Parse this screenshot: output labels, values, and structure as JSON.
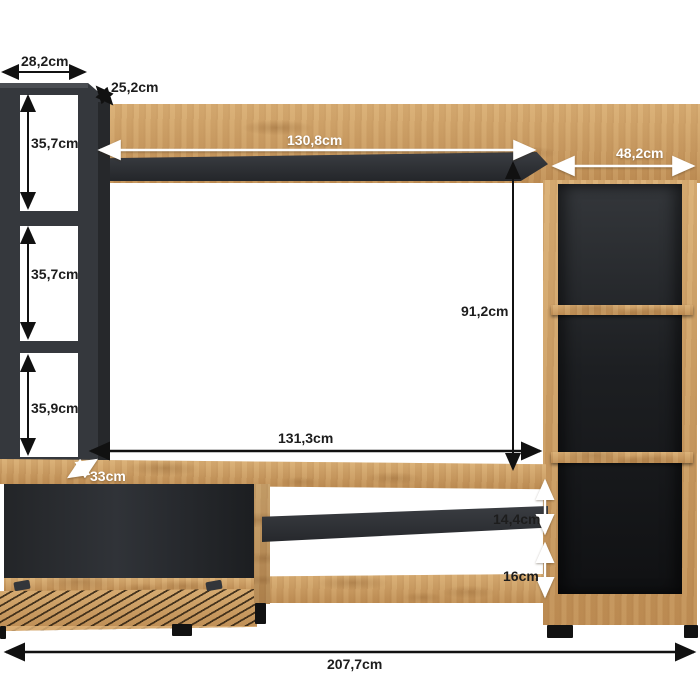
{
  "dims": {
    "left_unit_width": "28,2cm",
    "left_unit_depth": "25,2cm",
    "cubby_top_height": "35,7cm",
    "cubby_middle_height": "35,7cm",
    "cubby_bottom_height": "35,9cm",
    "wall_shelf_width": "130,8cm",
    "right_cabinet_width": "48,2cm",
    "niche_height": "91,2cm",
    "niche_width": "131,3cm",
    "tv_stand_depth": "33cm",
    "open_shelf_gap_upper": "14,4cm",
    "open_shelf_gap_lower": "16cm",
    "total_width": "207,7cm"
  },
  "colors": {
    "background": "#ffffff",
    "oak": "#c9995e",
    "anthracite_front": "#35383d",
    "anthracite_side": "#26282b",
    "glossy_back": "#1a1c1e",
    "arrow_black": "#111111",
    "arrow_white": "#ffffff",
    "feet": "#121212"
  }
}
